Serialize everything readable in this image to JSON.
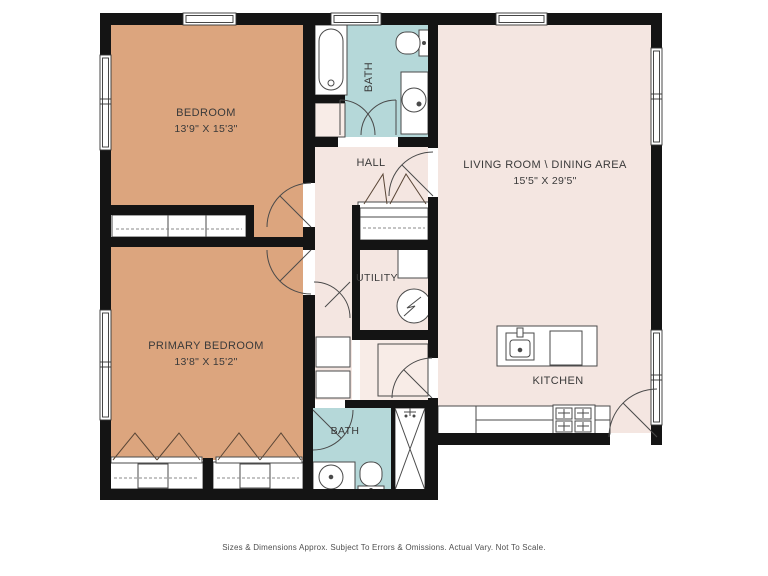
{
  "rooms": {
    "bedroom": {
      "label": "BEDROOM",
      "dims": "13'9\" X 15'3\""
    },
    "primary_bedroom": {
      "label": "PRIMARY BEDROOM",
      "dims": "13'8\" X 15'2\""
    },
    "living_dining": {
      "label": "LIVING ROOM \\ DINING AREA",
      "dims": "15'5\" X 29'5\""
    },
    "kitchen": {
      "label": "KITCHEN"
    },
    "hall": {
      "label": "HALL"
    },
    "utility": {
      "label": "UTILITY"
    },
    "bath_upper": {
      "label": "BATH"
    },
    "bath_lower": {
      "label": "BATH"
    }
  },
  "footer": {
    "disclaimer": "Sizes & Dimensions Approx. Subject To Errors & Omissions. Actual Vary. Not To Scale."
  },
  "colors": {
    "wall": "#141414",
    "bedroom_fill": "#dca57e",
    "bath_fill": "#b5d8d9",
    "living_fill": "#f4e6e1",
    "closet_fill": "#f8ece7",
    "fixture_line": "#4a4a4a",
    "label_text": "#3a3a3a",
    "caption_text": "#4f4f4f",
    "background": "#ffffff"
  },
  "fixtures": {
    "upper_bath": [
      "bathtub-icon",
      "toilet-icon",
      "sink-icon"
    ],
    "lower_bath": [
      "sink-icon",
      "toilet-icon",
      "shower-icon"
    ],
    "utility": [
      "washer-icon",
      "appliance-icon"
    ],
    "kitchen": [
      "island-sink-icon",
      "cooktop-icon",
      "range-icon",
      "refrigerator-icon"
    ]
  }
}
